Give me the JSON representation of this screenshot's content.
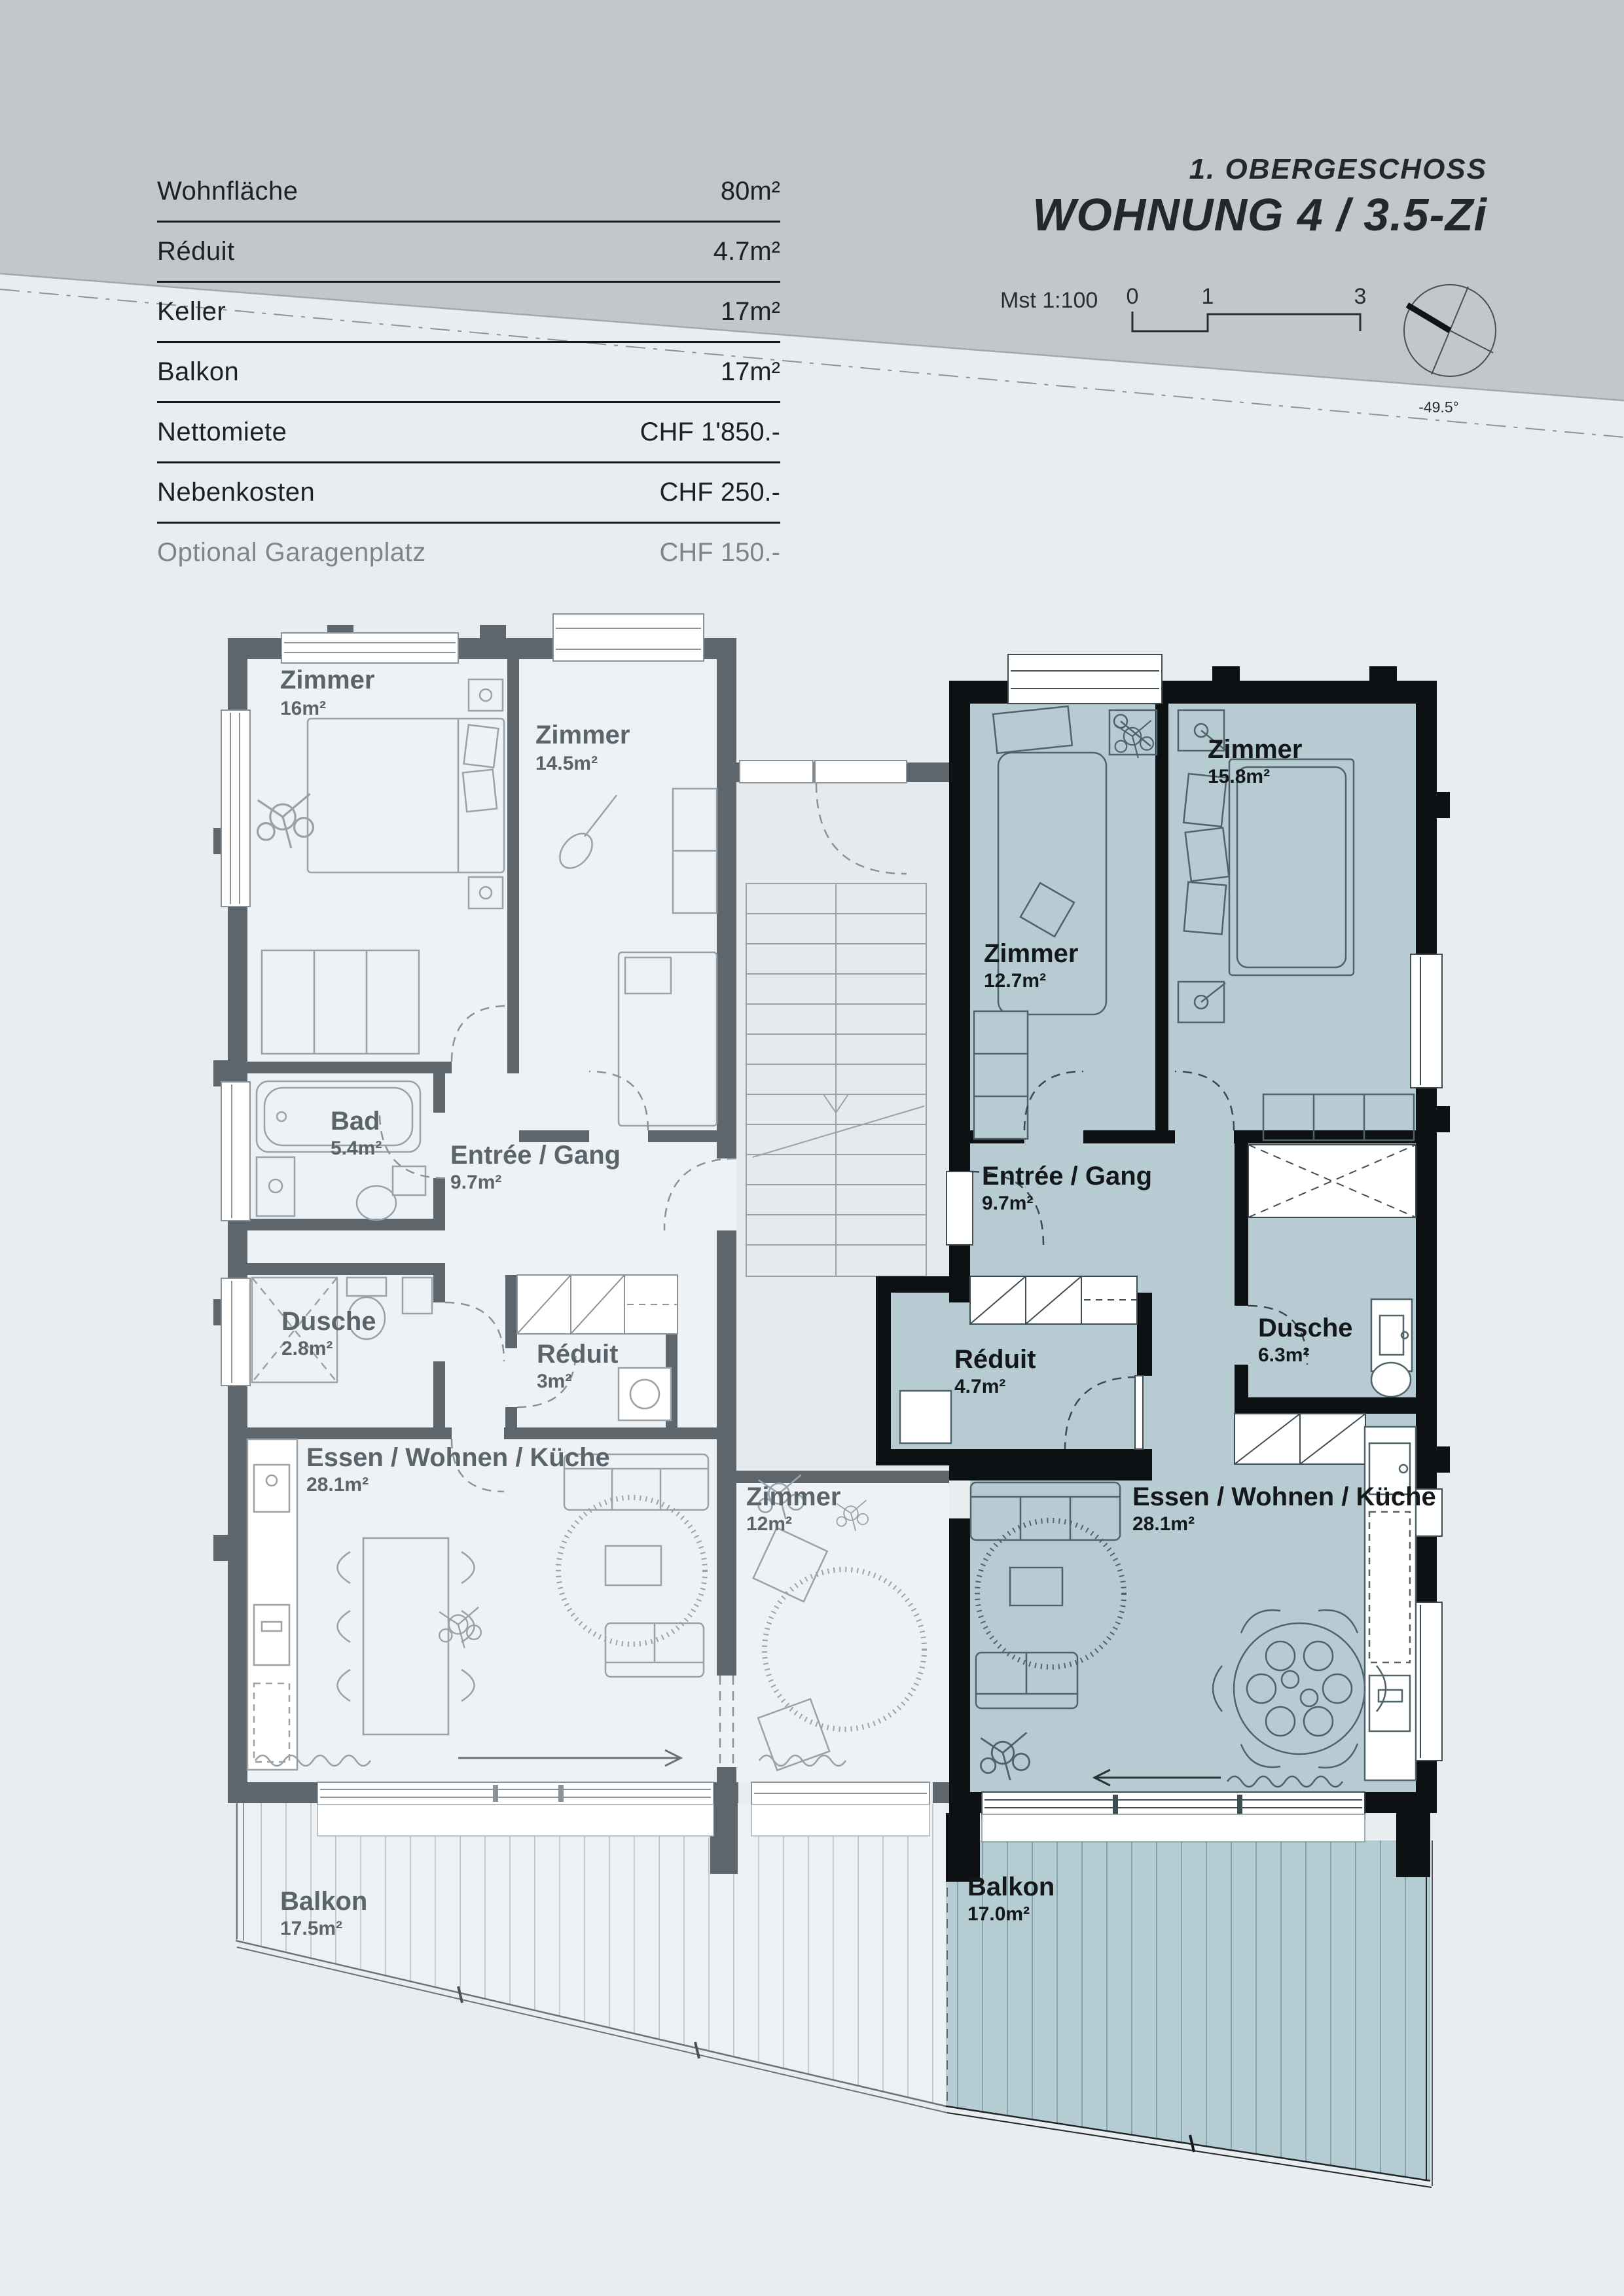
{
  "colors": {
    "page_background": "#e9edf0",
    "top_band": "#c4c7c9",
    "wall_gray": "#5d666d",
    "wall_black": "#0e1113",
    "floor_left_apartment": "#eef2f5",
    "floor_highlight_teal": "#b6ccd2",
    "table_line": "#14171a",
    "muted_text": "#7e868c"
  },
  "info_table": {
    "rows": [
      {
        "label": "Wohnfläche",
        "value": "80m²"
      },
      {
        "label": "Réduit",
        "value": "4.7m²"
      },
      {
        "label": "Keller",
        "value": "17m²"
      },
      {
        "label": "Balkon",
        "value": "17m²"
      },
      {
        "label": "Nettomiete",
        "value": "CHF 1'850.-"
      },
      {
        "label": "Nebenkosten",
        "value": "CHF 250.-"
      },
      {
        "label": "Optional Garagenplatz",
        "value": "CHF 150.-"
      }
    ]
  },
  "header": {
    "floor_label": "1. OBERGESCHOSS",
    "unit_title": "WOHNUNG 4 / 3.5-Zi",
    "scale_label": "Mst 1:100",
    "scale_ticks": [
      "0",
      "1",
      "3"
    ],
    "compass_angle": "-49.5°"
  },
  "floorplan": {
    "left": {
      "rooms": [
        {
          "name": "Zimmer",
          "area": "16m²"
        },
        {
          "name": "Zimmer",
          "area": "14.5m²"
        },
        {
          "name": "Bad",
          "area": "5.4m²"
        },
        {
          "name": "Entrée / Gang",
          "area": "9.7m²"
        },
        {
          "name": "Dusche",
          "area": "2.8m²"
        },
        {
          "name": "Réduit",
          "area": "3m²"
        },
        {
          "name": "Essen / Wohnen / Küche",
          "area": "28.1m²"
        },
        {
          "name": "Zimmer",
          "area": "12m²"
        },
        {
          "name": "Balkon",
          "area": "17.5m²"
        }
      ]
    },
    "right": {
      "rooms": [
        {
          "name": "Zimmer",
          "area": "12.7m²"
        },
        {
          "name": "Zimmer",
          "area": "15.8m²"
        },
        {
          "name": "Entrée / Gang",
          "area": "9.7m²"
        },
        {
          "name": "Réduit",
          "area": "4.7m²"
        },
        {
          "name": "Dusche",
          "area": "6.3m²"
        },
        {
          "name": "Essen / Wohnen / Küche",
          "area": "28.1m²"
        },
        {
          "name": "Balkon",
          "area": "17.0m²"
        }
      ]
    }
  }
}
